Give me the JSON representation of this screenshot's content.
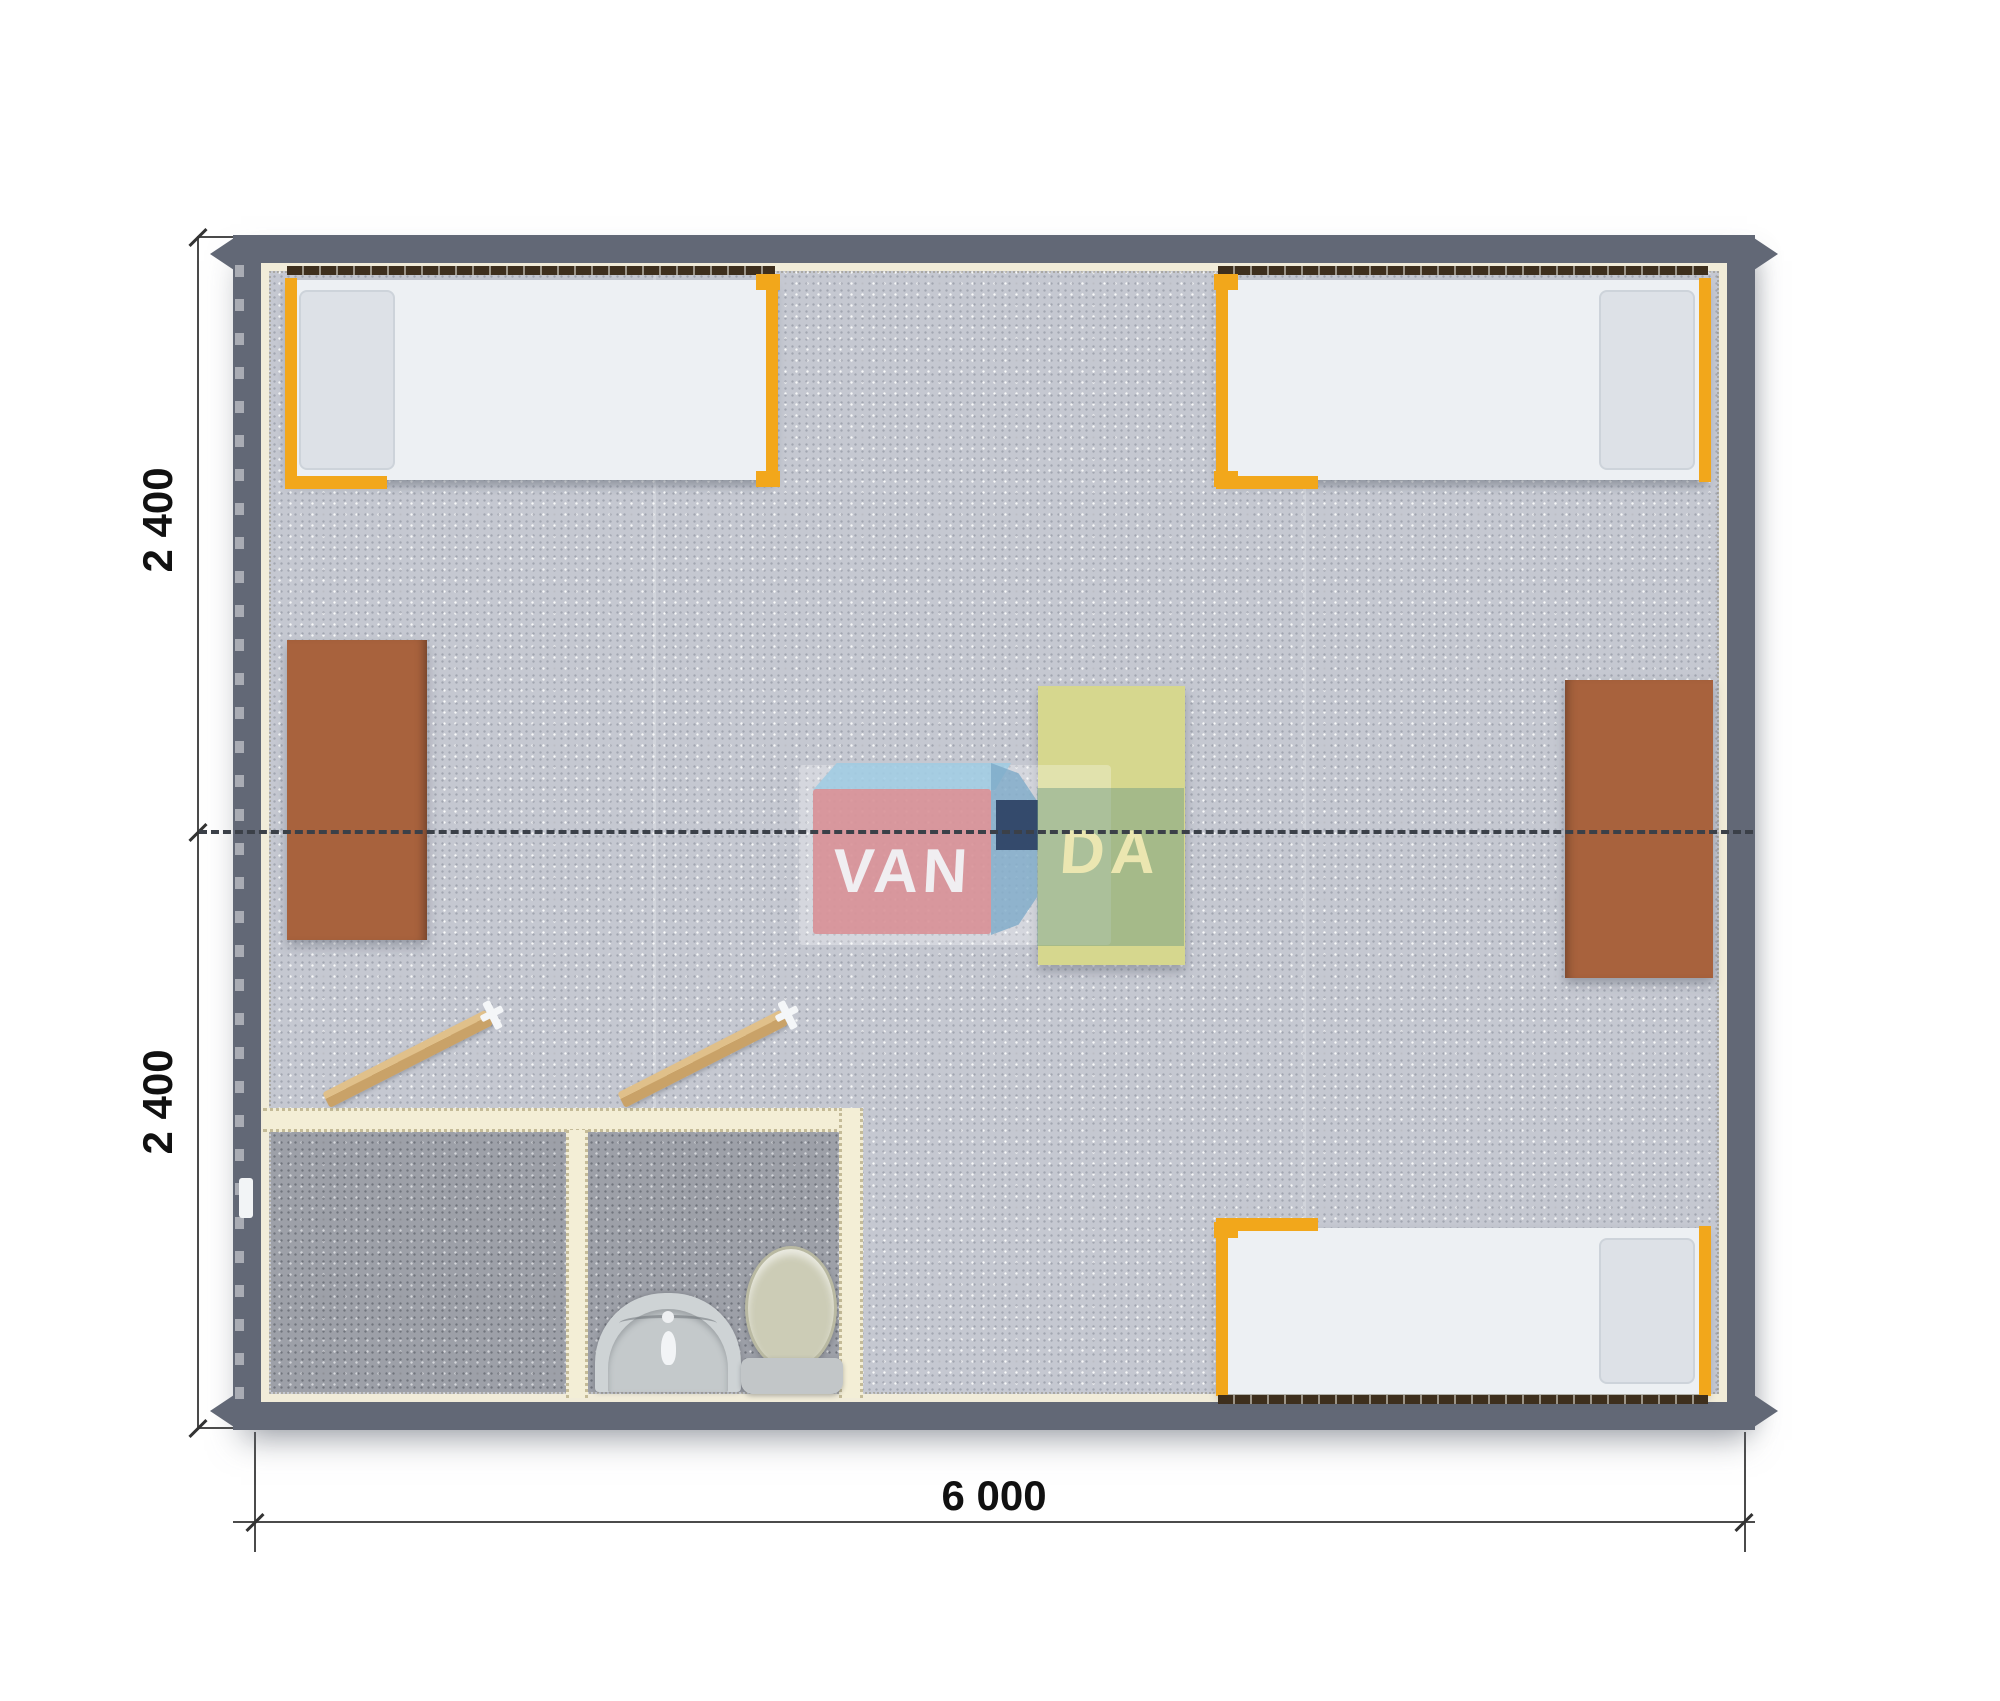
{
  "dimensions": {
    "vertical_top_label": "2 400",
    "vertical_bottom_label": "2 400",
    "horizontal_label": "6 000"
  },
  "watermark": {
    "brand_full": "VANDA",
    "text_left": "VAN",
    "text_right": "DA"
  },
  "colors": {
    "wall": "#626876",
    "floor": "#c5c8d1",
    "bathroom_floor": "#9da0a8",
    "partition_wall": "#f3eed6",
    "bed_frame_orange": "#f2a71b",
    "bed_wall_rail": "#3e2f1d",
    "mattress": "#edf0f3",
    "pillow": "#dde1e7",
    "table_brown": "#a8623d",
    "table_yellow": "#d6d78e",
    "door_leaf": "#d9b77e",
    "sink": "#ced3d5",
    "toilet_lid": "#ccccb6",
    "toilet_tank": "#c2c6c8",
    "dimension_line": "#4b4b4b",
    "dimension_text": "#111111",
    "centerline": "#3b4048",
    "watermark_pink": "rgba(216,144,150,0.9)",
    "watermark_light_blue": "rgba(158,203,227,0.85)",
    "watermark_blue": "rgba(125,170,200,0.8)",
    "watermark_navy": "rgba(47,68,102,0.95)",
    "watermark_letters_cream": "rgba(238,232,178,0.95)"
  },
  "furniture": {
    "items": [
      "single-bed-top-left",
      "single-bed-top-right",
      "single-bed-bottom-right",
      "desk-left",
      "desk-right",
      "desk-center",
      "wash-basin",
      "toilet",
      "door-left-room",
      "door-right-room",
      "exterior-door-handle"
    ]
  }
}
